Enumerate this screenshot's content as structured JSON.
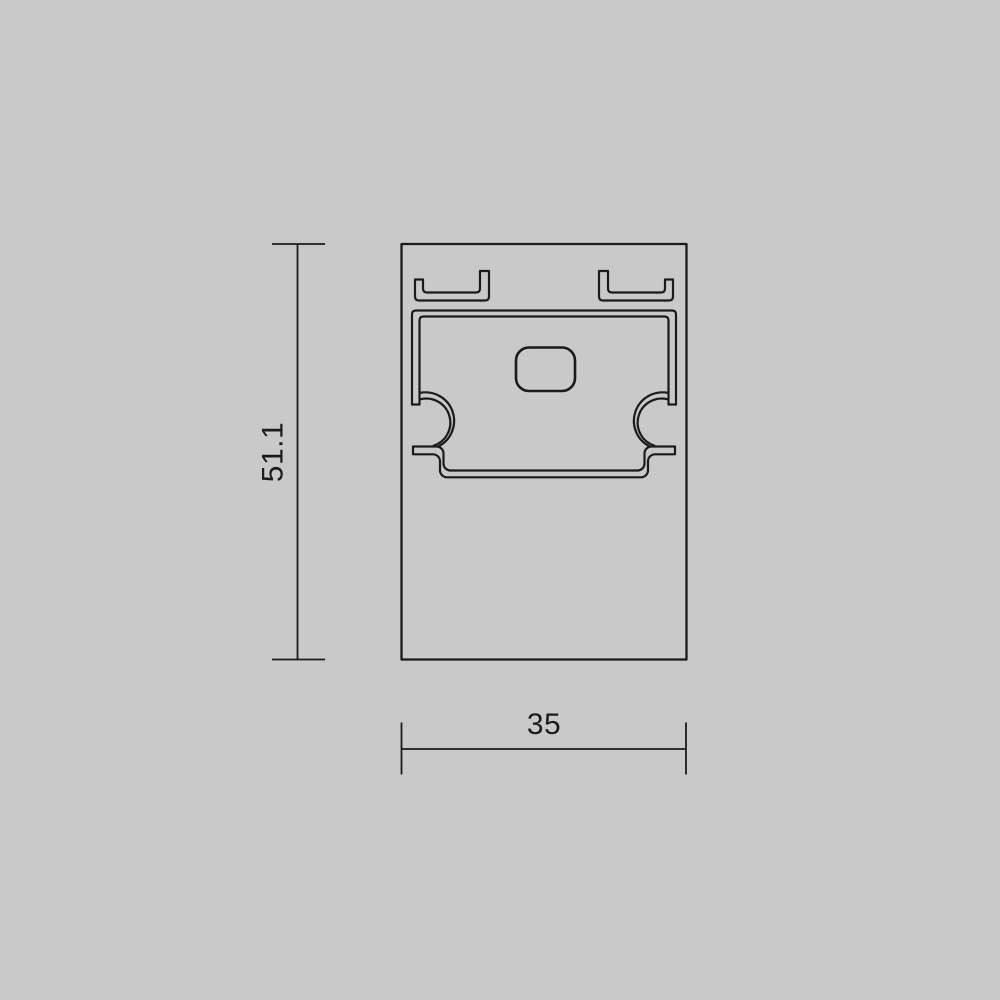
{
  "drawing": {
    "dimensions": {
      "height": {
        "label": "51.1"
      },
      "width": {
        "label": "35"
      }
    },
    "colors": {
      "background": "#c8c9c8",
      "line": "#1b1b1b"
    }
  }
}
